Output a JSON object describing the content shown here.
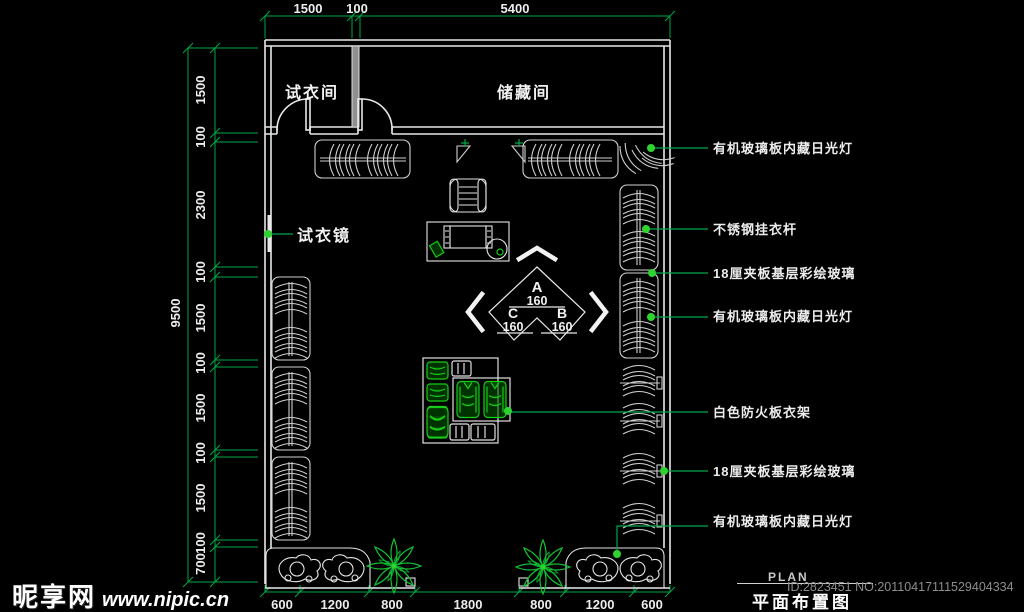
{
  "watermark": {
    "brand": "昵享网",
    "site": "www.nipic.cn"
  },
  "title_block": {
    "plan_en": "PLAN",
    "plan_cn": "平面布置图",
    "id_line": "ID:2823451 NO:20110417111529404334"
  },
  "rooms": {
    "fitting_room": "试衣间",
    "storage_room": "储藏间",
    "fitting_mirror": "试衣镜"
  },
  "callouts": {
    "right": [
      "有机玻璃板内藏日光灯",
      "不锈钢挂衣杆",
      "18厘夹板基层彩绘玻璃",
      "有机玻璃板内藏日光灯",
      "白色防火板衣架",
      "18厘夹板基层彩绘玻璃",
      "有机玻璃板内藏日光灯"
    ]
  },
  "elevation_marker": {
    "top_letter": "A",
    "top_value": "160",
    "left_letter": "C",
    "left_value": "160",
    "right_letter": "B",
    "right_value": "160"
  },
  "dimensions": {
    "top": [
      "1500",
      "100",
      "5400"
    ],
    "bottom": [
      "600",
      "1200",
      "800",
      "1800",
      "800",
      "1200",
      "600"
    ],
    "left": [
      "1500",
      "100",
      "2300",
      "100",
      "1500",
      "100",
      "1500",
      "100",
      "1500",
      "100",
      "700"
    ],
    "left_total": "9500"
  },
  "colors": {
    "background": "#000000",
    "dimension_green": "#00a848",
    "dot_green": "#2fd32f",
    "wall_white": "#e8e8e8",
    "garment_green": "#17cc17"
  }
}
